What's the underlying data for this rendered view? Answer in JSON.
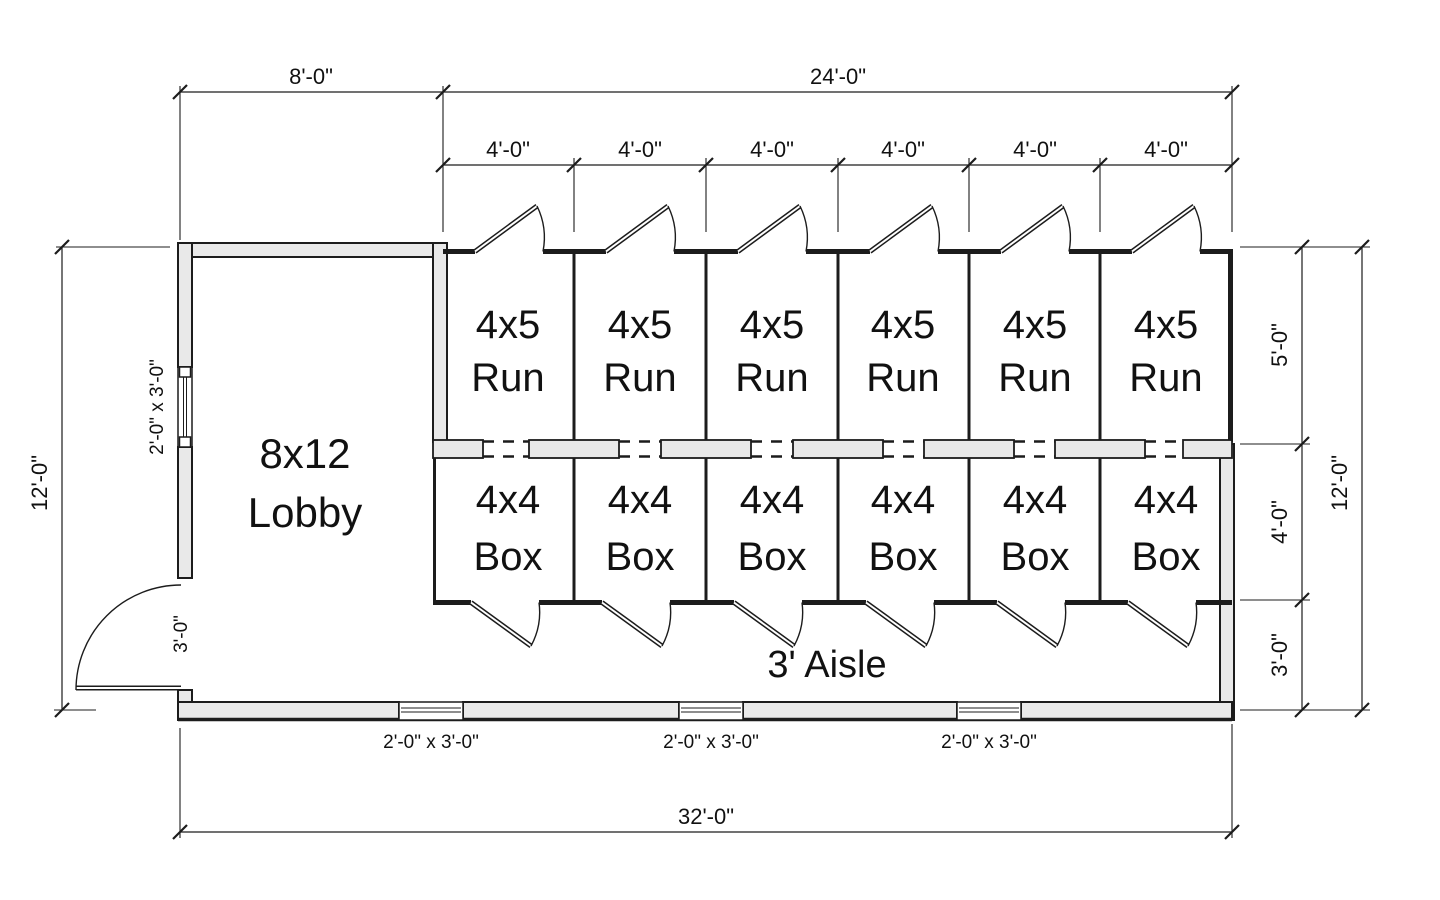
{
  "colors": {
    "background": "#ffffff",
    "line": "#1c1c1c",
    "wall_fill": "#e9e9e9"
  },
  "rooms": {
    "lobby": {
      "size": "8x12",
      "name": "Lobby"
    },
    "runs": [
      {
        "size": "4x5",
        "name": "Run"
      },
      {
        "size": "4x5",
        "name": "Run"
      },
      {
        "size": "4x5",
        "name": "Run"
      },
      {
        "size": "4x5",
        "name": "Run"
      },
      {
        "size": "4x5",
        "name": "Run"
      },
      {
        "size": "4x5",
        "name": "Run"
      }
    ],
    "boxes": [
      {
        "size": "4x4",
        "name": "Box"
      },
      {
        "size": "4x4",
        "name": "Box"
      },
      {
        "size": "4x4",
        "name": "Box"
      },
      {
        "size": "4x4",
        "name": "Box"
      },
      {
        "size": "4x4",
        "name": "Box"
      },
      {
        "size": "4x4",
        "name": "Box"
      }
    ],
    "aisle": {
      "name": "3' Aisle"
    }
  },
  "dimensions": {
    "top": {
      "lobby_width": "8'-0\"",
      "kennel_width": "24'-0\"",
      "cells": [
        "4'-0\"",
        "4'-0\"",
        "4'-0\"",
        "4'-0\"",
        "4'-0\"",
        "4'-0\""
      ]
    },
    "bottom": {
      "overall_width": "32'-0\"",
      "window_labels": [
        "2'-0\" x 3'-0\"",
        "2'-0\" x 3'-0\"",
        "2'-0\" x 3'-0\""
      ]
    },
    "left": {
      "overall_height": "12'-0\"",
      "window_label": "2'-0\" x 3'-0\"",
      "door_label": "3'-0\""
    },
    "right": {
      "run_depth": "5'-0\"",
      "box_depth": "4'-0\"",
      "aisle_depth": "3'-0\"",
      "overall_height": "12'-0\""
    }
  }
}
